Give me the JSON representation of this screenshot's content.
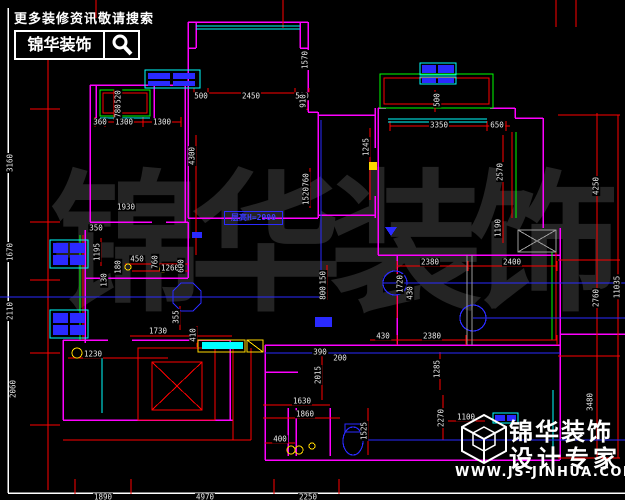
{
  "header": {
    "hint": "更多装修资讯敬请搜索",
    "brand": "锦华装饰"
  },
  "footer": {
    "brand": "锦华装饰",
    "tagline": "设计专家",
    "url": "WWW.JS-JINHUA.COM"
  },
  "plan": {
    "room_label": "层高H=2900",
    "watermark": [
      {
        "ch": "锦",
        "x": 50
      },
      {
        "ch": "华",
        "x": 190
      },
      {
        "ch": "装",
        "x": 330
      },
      {
        "ch": "饰",
        "x": 468
      }
    ],
    "dimensions": [
      {
        "t": "500",
        "x": 201,
        "y": 96
      },
      {
        "t": "2450",
        "x": 251,
        "y": 96
      },
      {
        "t": "500",
        "x": 302,
        "y": 96
      },
      {
        "t": "360",
        "x": 100,
        "y": 122
      },
      {
        "t": "1300",
        "x": 124,
        "y": 122
      },
      {
        "t": "1300",
        "x": 162,
        "y": 122
      },
      {
        "t": "3350",
        "x": 439,
        "y": 125
      },
      {
        "t": "650",
        "x": 497,
        "y": 125
      },
      {
        "t": "1930",
        "x": 126,
        "y": 207
      },
      {
        "t": "450",
        "x": 137,
        "y": 259
      },
      {
        "t": "1260",
        "x": 170,
        "y": 268
      },
      {
        "t": "350",
        "x": 96,
        "y": 228
      },
      {
        "t": "2380",
        "x": 430,
        "y": 262
      },
      {
        "t": "2400",
        "x": 512,
        "y": 262
      },
      {
        "t": "1730",
        "x": 158,
        "y": 331
      },
      {
        "t": "430",
        "x": 383,
        "y": 336
      },
      {
        "t": "2380",
        "x": 432,
        "y": 336
      },
      {
        "t": "1230",
        "x": 93,
        "y": 354
      },
      {
        "t": "390",
        "x": 320,
        "y": 352
      },
      {
        "t": "200",
        "x": 340,
        "y": 358
      },
      {
        "t": "1630",
        "x": 302,
        "y": 401
      },
      {
        "t": "1860",
        "x": 305,
        "y": 414
      },
      {
        "t": "400",
        "x": 280,
        "y": 439
      },
      {
        "t": "1100",
        "x": 466,
        "y": 417
      },
      {
        "t": "1890",
        "x": 103,
        "y": 497
      },
      {
        "t": "4970",
        "x": 205,
        "y": 497
      },
      {
        "t": "2250",
        "x": 308,
        "y": 497
      },
      {
        "t": "1570",
        "x": 305,
        "y": 60,
        "r": 1
      },
      {
        "t": "910",
        "x": 303,
        "y": 101,
        "r": 1
      },
      {
        "t": "520",
        "x": 118,
        "y": 97,
        "r": 1
      },
      {
        "t": "780",
        "x": 118,
        "y": 111,
        "r": 1
      },
      {
        "t": "500",
        "x": 437,
        "y": 100,
        "r": 1
      },
      {
        "t": "3160",
        "x": 10,
        "y": 163,
        "r": 1
      },
      {
        "t": "1670",
        "x": 10,
        "y": 252,
        "r": 1
      },
      {
        "t": "2110",
        "x": 10,
        "y": 311,
        "r": 1
      },
      {
        "t": "2060",
        "x": 13,
        "y": 389,
        "r": 1
      },
      {
        "t": "4250",
        "x": 596,
        "y": 186,
        "r": 1
      },
      {
        "t": "2760",
        "x": 596,
        "y": 298,
        "r": 1
      },
      {
        "t": "11035",
        "x": 617,
        "y": 287,
        "r": 1
      },
      {
        "t": "3480",
        "x": 590,
        "y": 402,
        "r": 1
      },
      {
        "t": "4300",
        "x": 192,
        "y": 156,
        "r": 1
      },
      {
        "t": "760",
        "x": 306,
        "y": 180,
        "r": 1
      },
      {
        "t": "1520",
        "x": 306,
        "y": 196,
        "r": 1
      },
      {
        "t": "1245",
        "x": 366,
        "y": 147,
        "r": 1
      },
      {
        "t": "2570",
        "x": 500,
        "y": 172,
        "r": 1
      },
      {
        "t": "1190",
        "x": 498,
        "y": 228,
        "r": 1
      },
      {
        "t": "1720",
        "x": 400,
        "y": 284,
        "r": 1
      },
      {
        "t": "1195",
        "x": 97,
        "y": 252,
        "r": 1
      },
      {
        "t": "180",
        "x": 118,
        "y": 267,
        "r": 1
      },
      {
        "t": "760",
        "x": 155,
        "y": 262,
        "r": 1
      },
      {
        "t": "600",
        "x": 181,
        "y": 266,
        "r": 1
      },
      {
        "t": "130",
        "x": 104,
        "y": 280,
        "r": 1
      },
      {
        "t": "355",
        "x": 176,
        "y": 317,
        "r": 1
      },
      {
        "t": "410",
        "x": 193,
        "y": 335,
        "r": 1
      },
      {
        "t": "1150",
        "x": 323,
        "y": 280,
        "r": 1
      },
      {
        "t": "800",
        "x": 323,
        "y": 293,
        "r": 1
      },
      {
        "t": "430",
        "x": 410,
        "y": 293,
        "r": 1
      },
      {
        "t": "2015",
        "x": 318,
        "y": 375,
        "r": 1
      },
      {
        "t": "1525",
        "x": 364,
        "y": 431,
        "r": 1
      },
      {
        "t": "1285",
        "x": 437,
        "y": 369,
        "r": 1
      },
      {
        "t": "2270",
        "x": 441,
        "y": 418,
        "r": 1
      }
    ]
  },
  "colors": {
    "background": "#000000",
    "wall": "#ff00ff",
    "dimension": "#ff0000",
    "bay_window": "#00ff00",
    "glass": "#00ffff",
    "fixture_blue": "#2a2aff",
    "text": "#e8e8e8",
    "counter_yellow": "#ffd700"
  }
}
